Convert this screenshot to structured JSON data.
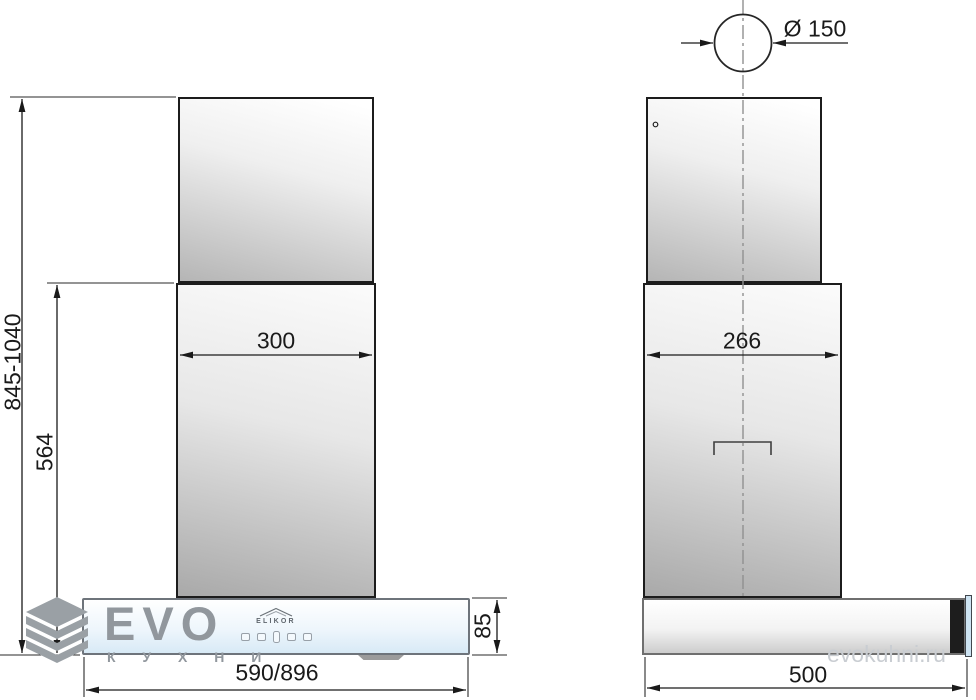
{
  "drawing": {
    "type": "kitchen-hood installation drawing, front and side views",
    "background": "#ffffff"
  },
  "dimensions": {
    "height_range": "845-1040",
    "lower_section_height": "564",
    "chimney_width": "300",
    "body_height": "85",
    "body_width": "590/896",
    "flue_diameter": "Ø 150",
    "chimney_depth": "266",
    "body_depth": "500"
  },
  "brand": {
    "logo_text": "ELIKOR"
  },
  "watermark": {
    "logo_main": "EVO",
    "logo_sub": "К У Х Н И",
    "site": "evokuhni.ru"
  },
  "icons": {
    "watermark_logo": "isometric-cube-icon",
    "brand_mark": "roof-outline-icon",
    "controls": [
      "button-icon",
      "button-icon",
      "display-icon",
      "button-icon",
      "button-icon"
    ]
  },
  "colors": {
    "line": "#1a1a1a",
    "centerline": "#909090",
    "glass_blue": "#d8eaf6",
    "metal_gray": "#a9a9a9",
    "watermark_gray": "#91979d",
    "watermark_light": "#c9cdd2"
  }
}
